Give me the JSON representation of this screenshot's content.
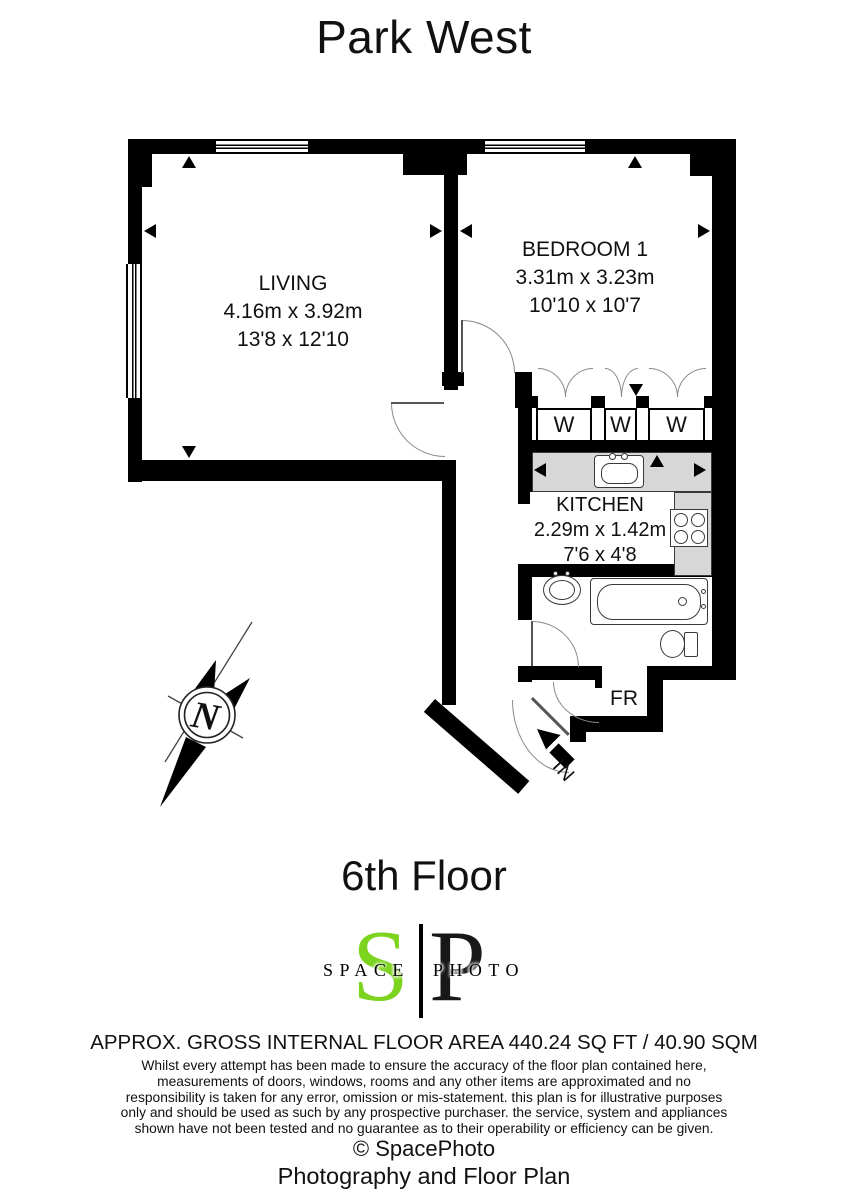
{
  "title": "Park West",
  "floor": "6th Floor",
  "plan": {
    "living": {
      "name": "LIVING",
      "metric": "4.16m x 3.92m",
      "imperial": "13'8 x 12'10"
    },
    "bedroom": {
      "name": "BEDROOM 1",
      "metric": "3.31m x 3.23m",
      "imperial": "10'10 x 10'7"
    },
    "kitchen": {
      "name": "KITCHEN",
      "metric": "2.29m x 1.42m",
      "imperial": "7'6 x 4'8"
    },
    "wardrobes": [
      "W",
      "W",
      "W"
    ],
    "fr_label": "FR",
    "entrance_label": "IN",
    "compass_north": "N"
  },
  "logo": {
    "initial_s": "S",
    "initial_p": "P",
    "wordmark": "SPACE PHOTO",
    "green": "#7cd41e"
  },
  "footer": {
    "area_line": "APPROX. GROSS INTERNAL FLOOR AREA 440.24 SQ FT / 40.90 SQM",
    "disclaimer_lines": [
      "Whilst every attempt has been made to ensure the accuracy of the floor plan contained here,",
      "measurements of doors, windows, rooms and any other items are approximated and no",
      "responsibility is taken for any error, omission or mis-statement. this plan is for illustrative purposes",
      "only and should be used as such by any prospective purchaser. the service, system and appliances",
      "shown have not been tested and no guarantee as to their operability or efficiency can be given.",
      "© SpacePhoto",
      "Photography and Floor Plan"
    ]
  },
  "colors": {
    "wall": "#000000",
    "counter": "#d7d7d7",
    "logo_green": "#7cd41e"
  }
}
